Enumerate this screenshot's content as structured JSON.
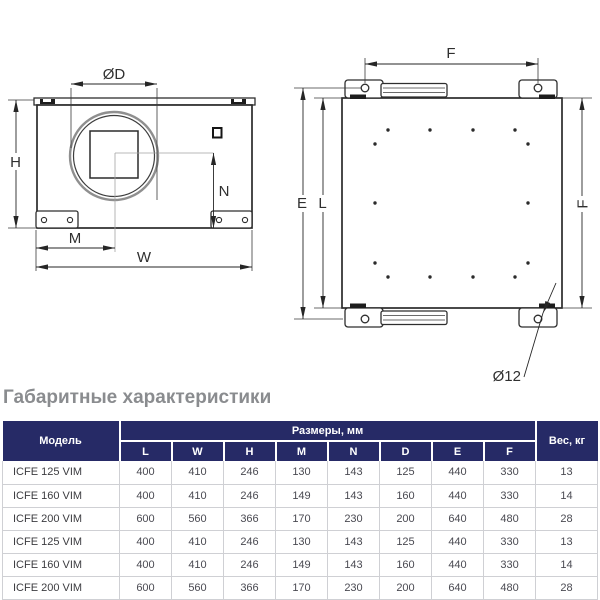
{
  "drawing": {
    "side_view": {
      "dim_d": "ØD",
      "dim_h": "H",
      "dim_n": "N",
      "dim_m": "M",
      "dim_w": "W"
    },
    "front_view": {
      "dim_f_top": "F",
      "dim_e": "E",
      "dim_l": "L",
      "dim_f_side": "F",
      "dim_hole_dia": "Ø12"
    }
  },
  "section": {
    "title": "Габаритные характеристики"
  },
  "table": {
    "header": {
      "model": "Модель",
      "dimensions_group": "Размеры, мм",
      "weight": "Вес, кг",
      "dimension_columns": [
        "L",
        "W",
        "H",
        "M",
        "N",
        "D",
        "E",
        "F"
      ]
    },
    "rows": [
      {
        "model": "ICFE 125 VIM",
        "values": [
          "400",
          "410",
          "246",
          "130",
          "143",
          "125",
          "440",
          "330"
        ],
        "weight": "13"
      },
      {
        "model": "ICFE 160 VIM",
        "values": [
          "400",
          "410",
          "246",
          "149",
          "143",
          "160",
          "440",
          "330"
        ],
        "weight": "14"
      },
      {
        "model": "ICFE 200 VIM",
        "values": [
          "600",
          "560",
          "366",
          "170",
          "230",
          "200",
          "640",
          "480"
        ],
        "weight": "28"
      },
      {
        "model": "ICFE 125 VIM",
        "values": [
          "400",
          "410",
          "246",
          "130",
          "143",
          "125",
          "440",
          "330"
        ],
        "weight": "13"
      },
      {
        "model": "ICFE 160 VIM",
        "values": [
          "400",
          "410",
          "246",
          "149",
          "143",
          "160",
          "440",
          "330"
        ],
        "weight": "14"
      },
      {
        "model": "ICFE 200 VIM",
        "values": [
          "600",
          "560",
          "366",
          "170",
          "230",
          "200",
          "640",
          "480"
        ],
        "weight": "28"
      }
    ],
    "colors": {
      "header_bg": "#262a66",
      "header_text": "#ffffff",
      "row_border": "#cfd0d4",
      "data_text": "#4a4a52",
      "title_text": "#8a8c8f"
    }
  }
}
